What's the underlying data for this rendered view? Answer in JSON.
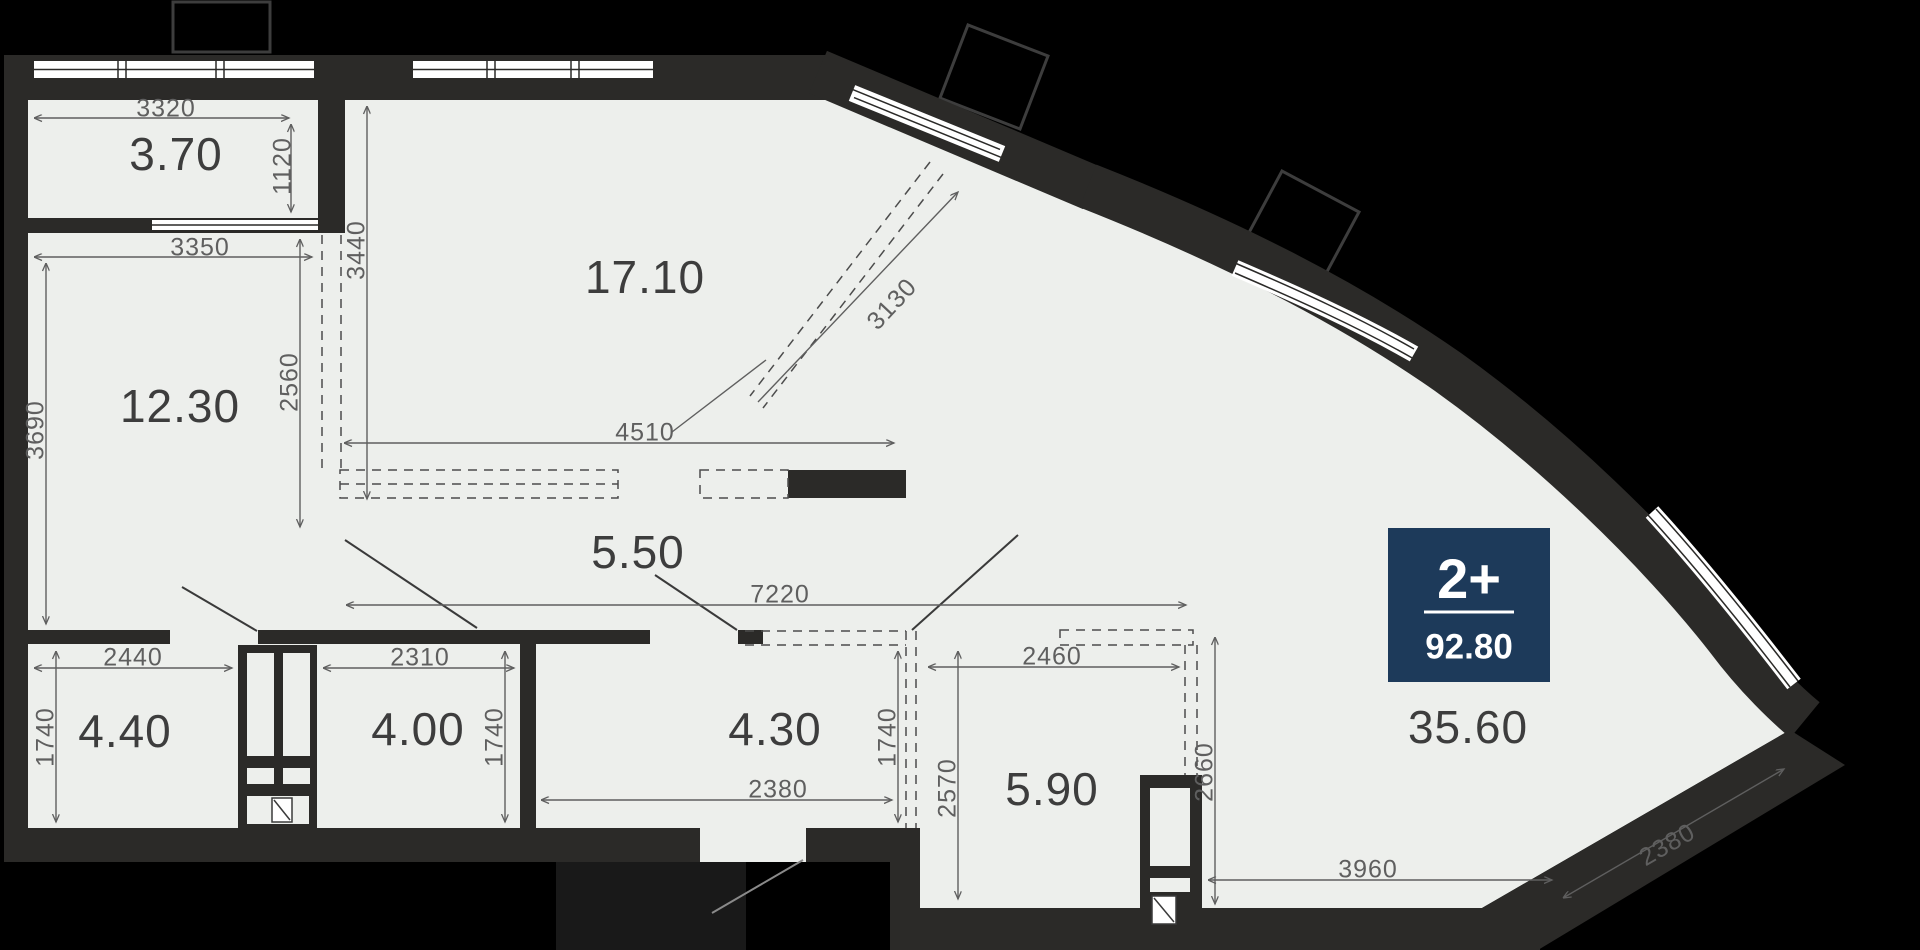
{
  "plan": {
    "type": "apartment-floor-plan",
    "badge": {
      "rooms_type": "2+",
      "total_area": "92.80"
    },
    "rooms": {
      "balcony": "3.70",
      "living": "17.10",
      "bedroom": "12.30",
      "corridor": "5.50",
      "bath1": "4.40",
      "bath2": "4.00",
      "hall": "4.30",
      "kitchen": "5.90",
      "main": "35.60"
    },
    "dims": {
      "balcony_w": "3320",
      "balcony_d": "1120",
      "bedroom_w": "3350",
      "bedroom_h": "3690",
      "bedroom_split": "2560",
      "living_h": "3440",
      "closet_span": "4510",
      "diag_span": "3130",
      "corridor_span": "7220",
      "bath1_w": "2440",
      "bath1_d": "1740",
      "bath2_w": "2310",
      "bath2_d": "1740",
      "hall_w": "2380",
      "hall_d": "1740",
      "kitchen_d": "2570",
      "kitchen_w": "2460",
      "kitchen_r": "2660",
      "main_w": "3960",
      "main_diag": "2380"
    },
    "colors": {
      "wall": "#2b2a28",
      "floor": "#edefec",
      "badge": "#1d3a5a",
      "dim_line": "#5f5f5f"
    }
  }
}
